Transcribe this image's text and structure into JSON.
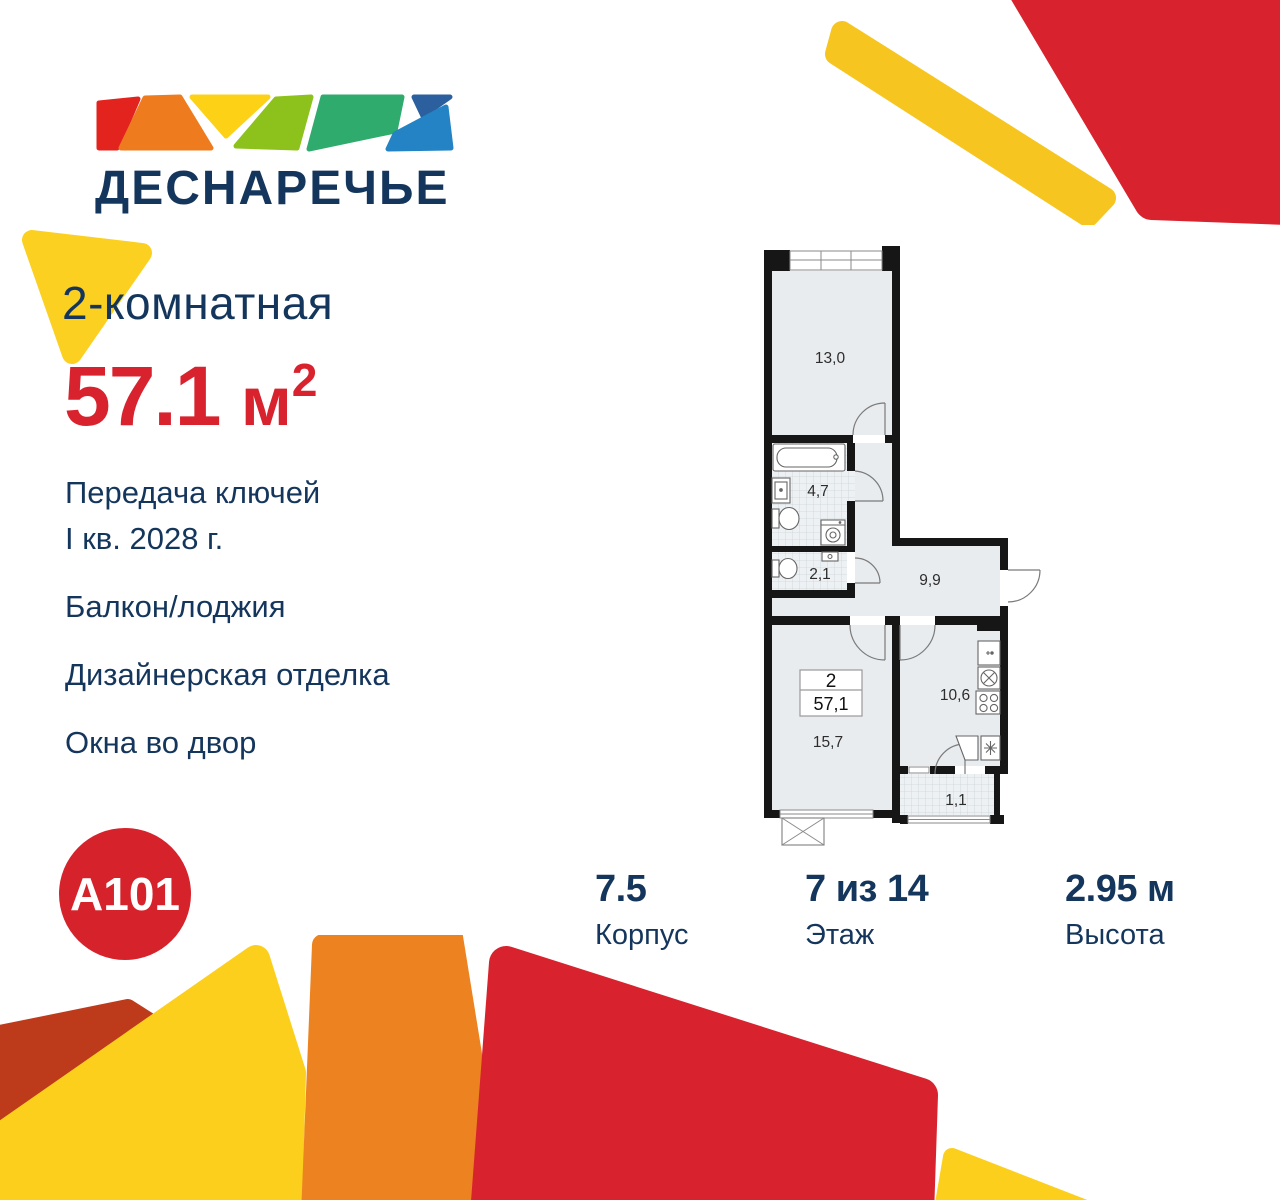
{
  "brand": {
    "project_name": "ДЕСНАРЕЧЬЕ",
    "developer_logo": "А101"
  },
  "listing": {
    "type_title": "2-комнатная",
    "area_value": "57.1",
    "area_unit": "м",
    "area_exponent": "2"
  },
  "features": [
    [
      "Передача ключей",
      "I кв. 2028 г."
    ],
    [
      "Балкон/лоджия"
    ],
    [
      "Дизайнерская отделка"
    ],
    [
      "Окна во двор"
    ]
  ],
  "floor_plan": {
    "areas": {
      "bedroom": "13,0",
      "bathroom": "4,7",
      "wc": "2,1",
      "hallway": "9,9",
      "living_room": "15,7",
      "kitchen": "10,6",
      "balcony": "1,1"
    },
    "flat_badge": {
      "rooms": "2",
      "total_area": "57,1"
    }
  },
  "specs": [
    {
      "value": "7.5",
      "label": "Корпус"
    },
    {
      "value": "7 из 14",
      "label": "Этаж"
    },
    {
      "value": "2.95 м",
      "label": "Высота"
    }
  ],
  "colors": {
    "navy": "#15365c",
    "red": "#d8232e",
    "logo_red": "#e2231e",
    "yellow": "#fccf1d",
    "orange": "#ec8320",
    "brick": "#bd3b1b",
    "light_green": "#8dc21c",
    "teal": "#2fab6e",
    "dark_blue": "#2c5f9e",
    "light_blue": "#2383c4"
  }
}
